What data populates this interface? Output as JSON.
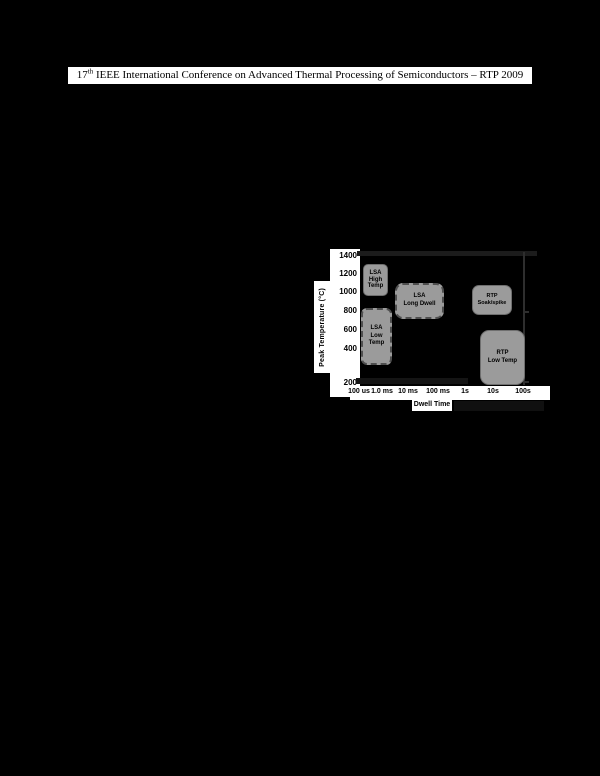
{
  "header": {
    "num": "17",
    "sup": "th",
    "rest": " IEEE International Conference on Advanced Thermal Processing of Semiconductors – RTP 2009"
  },
  "chart_data": {
    "type": "area",
    "description": "Process-window map of peak temperature versus dwell time showing LSA and RTP operating regions",
    "title": "",
    "xlabel": "Dwell Time",
    "ylabel": "Peak Temperature (°C)",
    "x_scale": "log",
    "x_ticks": [
      "100 us",
      "1.0 ms",
      "10 ms",
      "100 ms",
      "1s",
      "10s",
      "100s"
    ],
    "y_ticks": [
      "1400",
      "1200",
      "1000",
      "800",
      "600",
      "400",
      "200"
    ],
    "ylim": [
      200,
      1400
    ],
    "grid": false,
    "legend": false,
    "regions": [
      {
        "name": "LSA High Temp",
        "label_lines": [
          "LSA",
          "High",
          "Temp"
        ],
        "dwell_range": [
          "100 us",
          "1 ms"
        ],
        "temp_range_c": [
          1050,
          1320
        ],
        "border_style": "solid"
      },
      {
        "name": "LSA Long Dwell",
        "label_lines": [
          "LSA",
          "Long Dwell"
        ],
        "dwell_range": [
          "2 ms",
          "100 ms"
        ],
        "temp_range_c": [
          850,
          1150
        ],
        "border_style": "dashed"
      },
      {
        "name": "LSA Low Temp",
        "label_lines": [
          "LSA",
          "Low",
          "Temp"
        ],
        "dwell_range": [
          "100 us",
          "1 ms"
        ],
        "temp_range_c": [
          400,
          900
        ],
        "border_style": "dashed"
      },
      {
        "name": "RTP Soak/spike",
        "label_lines": [
          "RTP",
          "Soak/spike"
        ],
        "dwell_range": [
          "1.5 s",
          "30 s"
        ],
        "temp_range_c": [
          860,
          1130
        ],
        "border_style": "solid"
      },
      {
        "name": "RTP Low Temp",
        "label_lines": [
          "RTP",
          "Low Temp"
        ],
        "dwell_range": [
          "3 s",
          "100 s"
        ],
        "temp_range_c": [
          200,
          700
        ],
        "border_style": "solid"
      }
    ],
    "colors": {
      "region_fill": "#9b9b9b",
      "region_text": "#000000",
      "plot_background": "#000000",
      "axis_strip_background": "#ffffff"
    }
  }
}
